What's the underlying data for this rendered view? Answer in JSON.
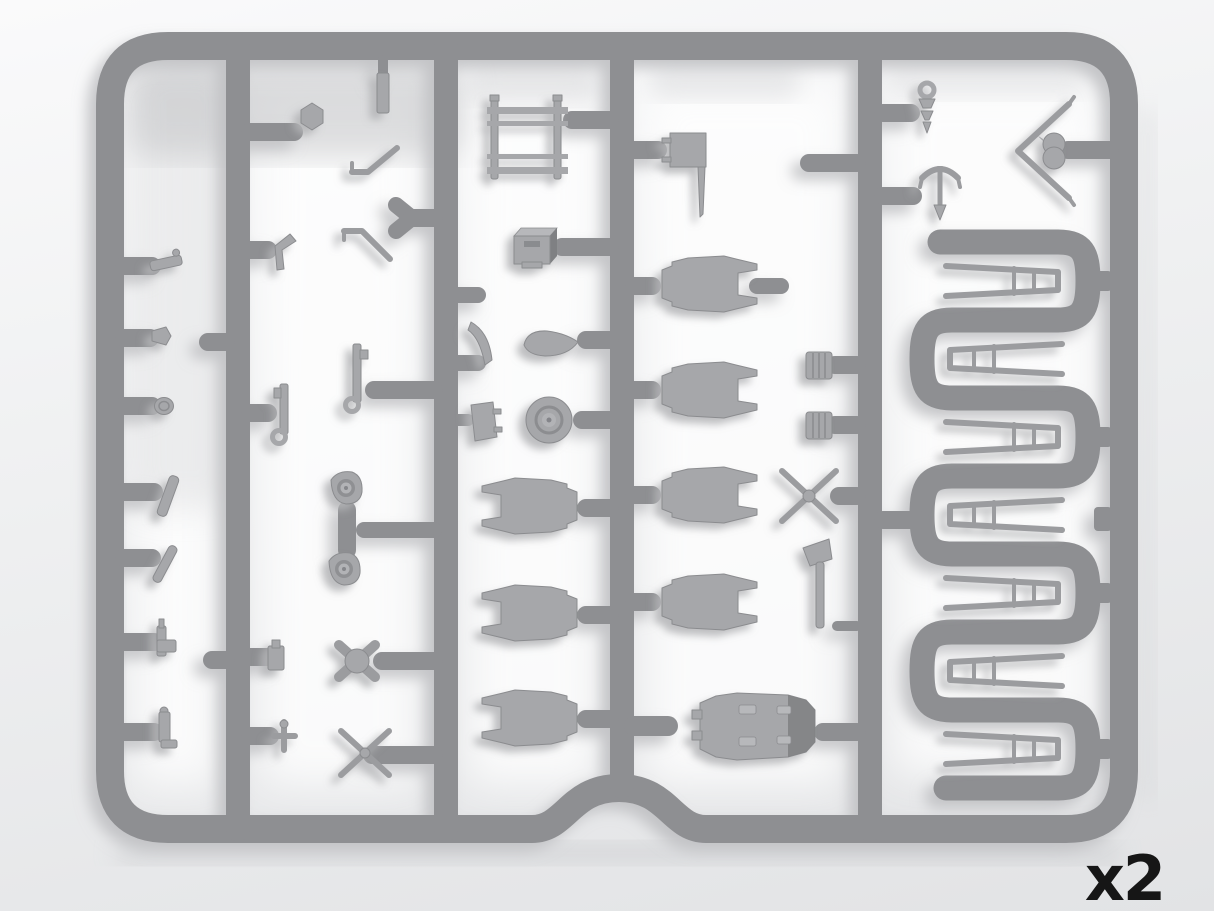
{
  "image": {
    "description_label": "Injection-molded plastic model sprue (gray styrene parts frame), rendered on light background",
    "quantity_label": "x2"
  },
  "palette": {
    "background_top": "#fafafb",
    "background_bottom": "#e2e3e5",
    "runner": "#8e8f92",
    "part": "#a6a7aa",
    "part_edge": "#8b8c8f",
    "part_dark": "#7f8083",
    "part_light": "#b7b8bb",
    "thin": "#9b9c9f",
    "shadow": "#b6b7ba",
    "label": "#161616"
  },
  "sprue": {
    "frame": {
      "left": 95,
      "top": 30,
      "right": 1138,
      "bottom": 843,
      "corner_radius": 70,
      "bottom_arch_center_x": 619,
      "note": "rounded-rectangle outer frame with upward arch notch in bottom rail"
    },
    "runners_x": [
      111,
      238,
      446,
      622,
      870,
      1124
    ],
    "serpentine": {
      "x_range": [
        909,
        1101
      ],
      "leg_ys": [
        242,
        320,
        398,
        476,
        554,
        632,
        710,
        788
      ]
    },
    "parts_inventory": [
      {
        "name": "clasp-small",
        "cx": 166,
        "cy": 263
      },
      {
        "name": "nub-arrow",
        "cx": 161,
        "cy": 336
      },
      {
        "name": "disc-small",
        "cx": 164,
        "cy": 406
      },
      {
        "name": "rod-angled-a",
        "cx": 168,
        "cy": 496
      },
      {
        "name": "rod-angled-b",
        "cx": 165,
        "cy": 564
      },
      {
        "name": "machine-gun-small",
        "cx": 166,
        "cy": 640
      },
      {
        "name": "pin-boot",
        "cx": 165,
        "cy": 730
      },
      {
        "name": "hex-knob",
        "cx": 312,
        "cy": 116
      },
      {
        "name": "mast-bar",
        "cx": 383,
        "cy": 93
      },
      {
        "name": "strut-angled-upper",
        "cx": 375,
        "cy": 160
      },
      {
        "name": "y-gate",
        "cx": 404,
        "cy": 218
      },
      {
        "name": "strut-angled-lower",
        "cx": 367,
        "cy": 245
      },
      {
        "name": "corner-bracket",
        "cx": 286,
        "cy": 252
      },
      {
        "name": "lewis-gun-a",
        "cx": 284,
        "cy": 413
      },
      {
        "name": "lewis-gun-b",
        "cx": 357,
        "cy": 380
      },
      {
        "name": "pulley-a",
        "cx": 346,
        "cy": 489
      },
      {
        "name": "pulley-b",
        "cx": 344,
        "cy": 570
      },
      {
        "name": "clip-small",
        "cx": 276,
        "cy": 658
      },
      {
        "name": "cross-small",
        "cx": 284,
        "cy": 736
      },
      {
        "name": "four-point-hub",
        "cx": 357,
        "cy": 661
      },
      {
        "name": "cross-brace-small",
        "cx": 365,
        "cy": 753
      },
      {
        "name": "step-ladder-frame",
        "cx": 527,
        "cy": 138
      },
      {
        "name": "ammo-box",
        "cx": 535,
        "cy": 246
      },
      {
        "name": "windshield-sliver",
        "cx": 481,
        "cy": 343
      },
      {
        "name": "spinner-teardrop",
        "cx": 551,
        "cy": 343
      },
      {
        "name": "foot-flap",
        "cx": 484,
        "cy": 421
      },
      {
        "name": "wheel",
        "cx": 549,
        "cy": 420
      },
      {
        "name": "cowl-panel-left-1",
        "cx": 530,
        "cy": 506
      },
      {
        "name": "cowl-panel-left-2",
        "cx": 530,
        "cy": 613
      },
      {
        "name": "cowl-panel-left-3",
        "cx": 530,
        "cy": 718
      },
      {
        "name": "seat-plate-with-pole",
        "cx": 688,
        "cy": 172
      },
      {
        "name": "cowl-panel-right-1",
        "cx": 708,
        "cy": 284
      },
      {
        "name": "cowl-panel-right-2",
        "cx": 708,
        "cy": 390
      },
      {
        "name": "cowl-panel-right-3",
        "cx": 708,
        "cy": 495
      },
      {
        "name": "cowl-panel-right-4",
        "cx": 708,
        "cy": 602
      },
      {
        "name": "barrel-a",
        "cx": 819,
        "cy": 365
      },
      {
        "name": "barrel-b",
        "cx": 819,
        "cy": 425
      },
      {
        "name": "x-brace",
        "cx": 809,
        "cy": 496
      },
      {
        "name": "control-lever",
        "cx": 818,
        "cy": 584
      },
      {
        "name": "engine-block",
        "cx": 757,
        "cy": 726
      },
      {
        "name": "screw-bolt",
        "cx": 927,
        "cy": 105
      },
      {
        "name": "grab-handle-trident",
        "cx": 940,
        "cy": 190
      },
      {
        "name": "vee-strut-chevron",
        "cx": 1043,
        "cy": 151
      },
      {
        "name": "cabane-strut-1",
        "cx": 1004,
        "cy": 281
      },
      {
        "name": "cabane-strut-2",
        "cx": 1004,
        "cy": 359
      },
      {
        "name": "cabane-strut-3",
        "cx": 1004,
        "cy": 437
      },
      {
        "name": "cabane-strut-4",
        "cx": 1004,
        "cy": 515
      },
      {
        "name": "cabane-strut-5",
        "cx": 1004,
        "cy": 593
      },
      {
        "name": "cabane-strut-6",
        "cx": 1004,
        "cy": 671
      },
      {
        "name": "cabane-strut-7",
        "cx": 1004,
        "cy": 749
      }
    ]
  }
}
